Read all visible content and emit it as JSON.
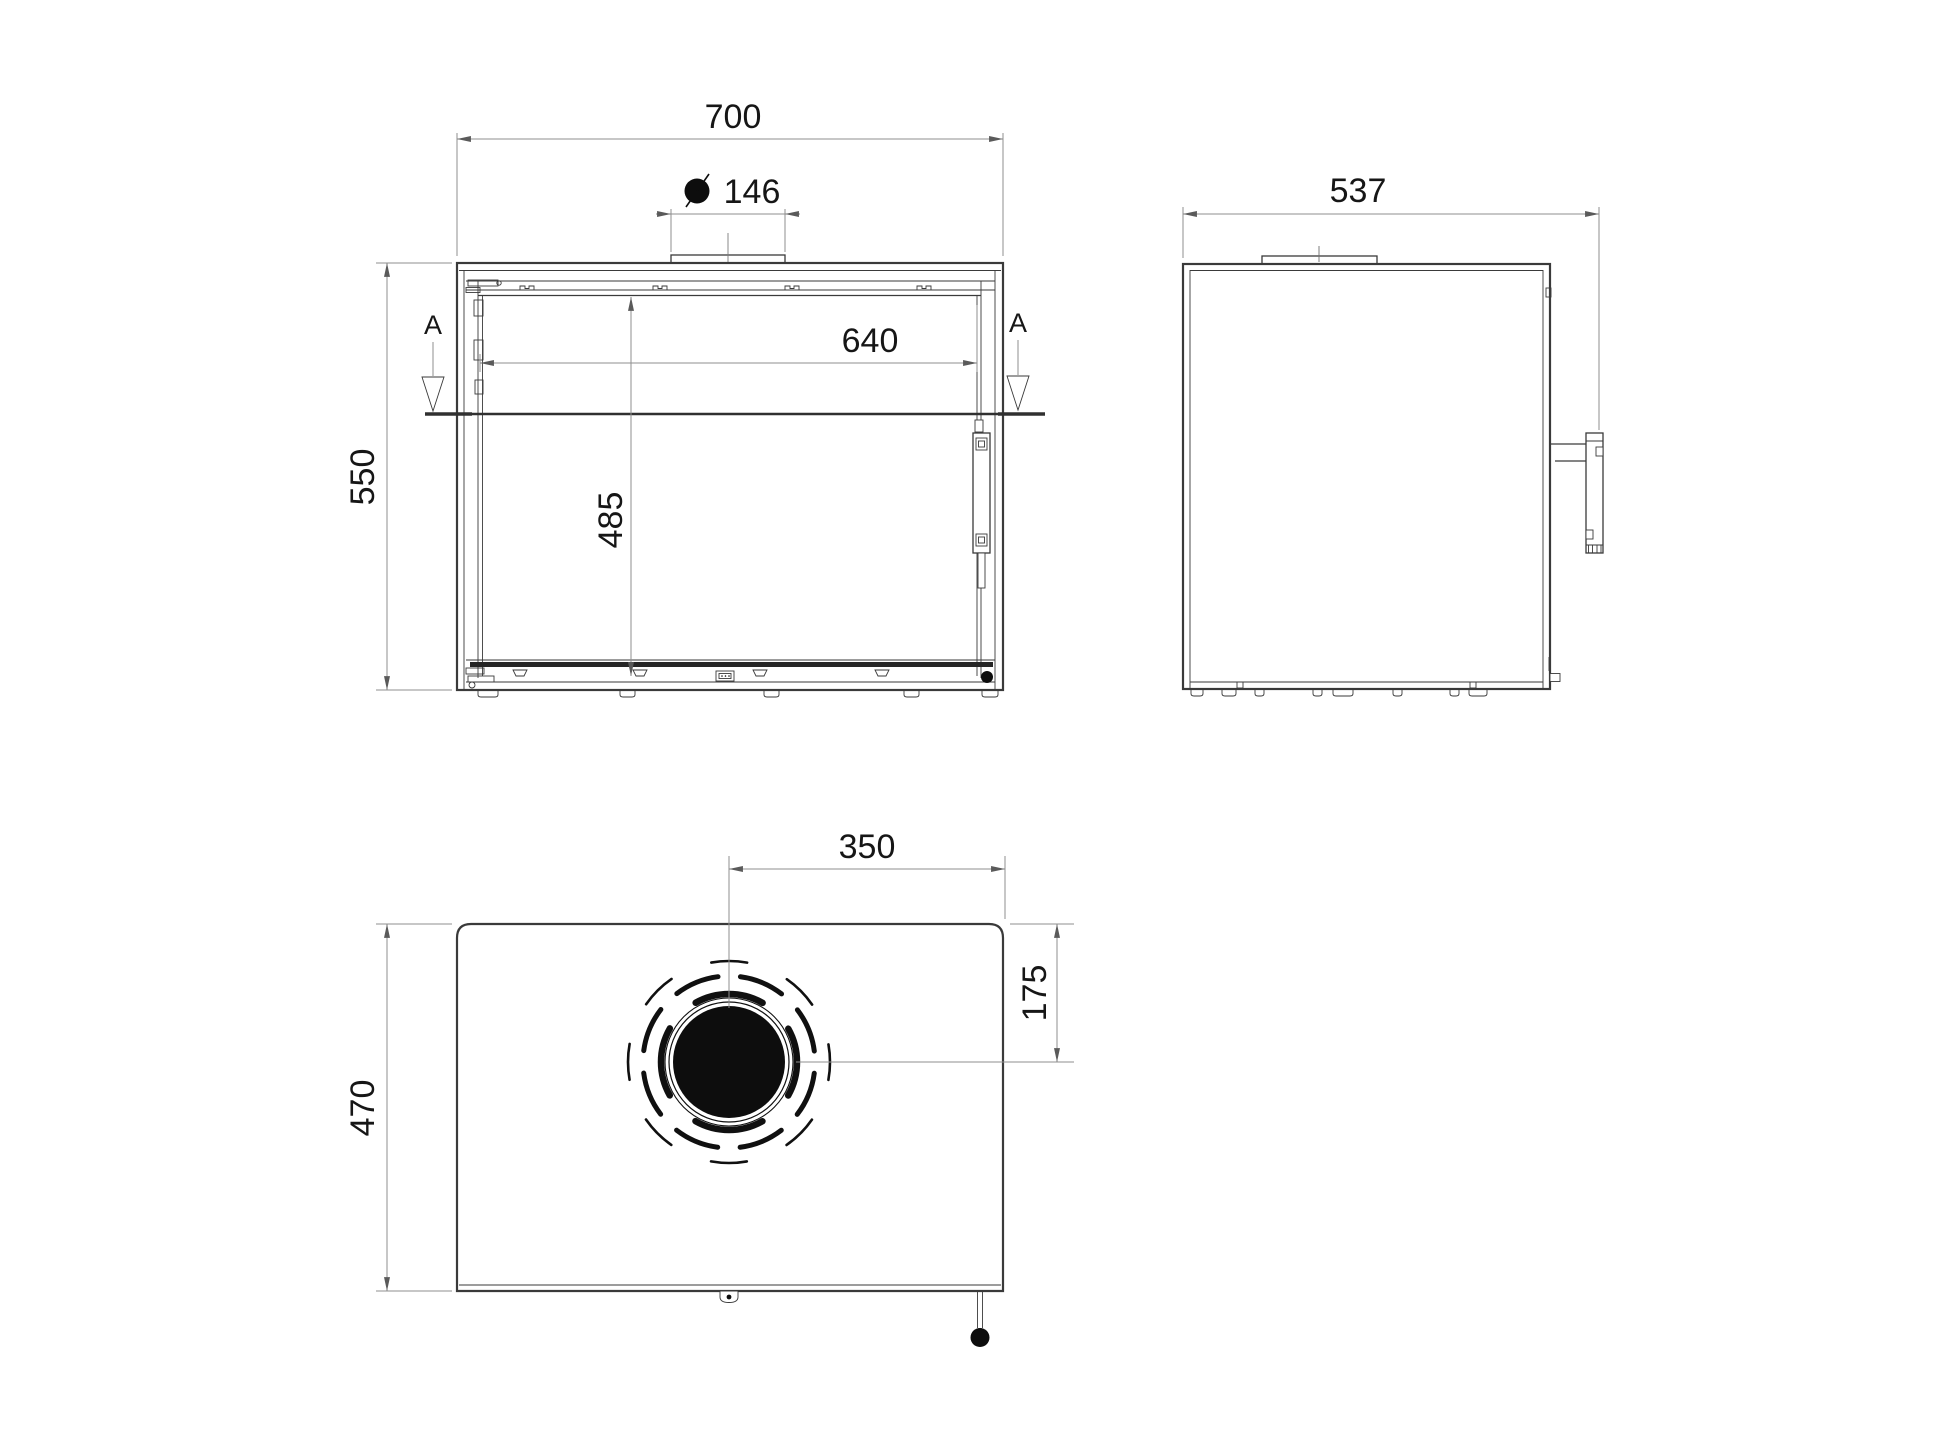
{
  "drawing": {
    "type": "technical-dimension-drawing",
    "background": "#ffffff",
    "colors": {
      "line": "#3a3a3a",
      "dim_line": "#8f8f8f",
      "text": "#161616",
      "solid_fill": "#0d0d0d"
    },
    "section": {
      "label": "A"
    },
    "icons": {
      "diameter_symbol": "filled-circle-slash"
    },
    "views": {
      "front": {
        "dims": {
          "overall_width": "700",
          "flue_collar_width": "146",
          "door_opening_width": "640",
          "door_opening_height": "485",
          "overall_height": "550"
        }
      },
      "side": {
        "dims": {
          "overall_depth": "537"
        }
      },
      "top": {
        "dims": {
          "flue_center_offset_x": "350",
          "flue_center_offset_y": "175",
          "body_depth": "470"
        }
      }
    }
  }
}
